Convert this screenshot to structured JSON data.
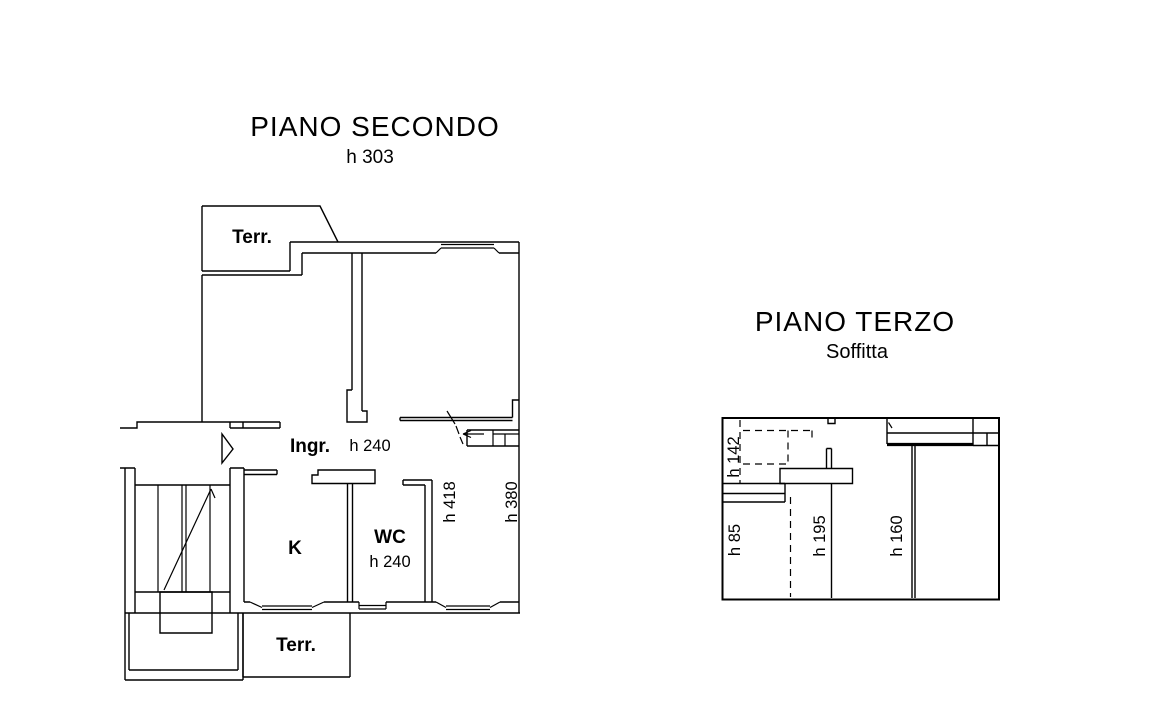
{
  "colors": {
    "ink": "#000000",
    "paper": "#ffffff"
  },
  "plan_secondo": {
    "title": "PIANO SECONDO",
    "height_note": "h 303",
    "labels": {
      "terrace_top": "Terr.",
      "entrance": "Ingr.",
      "entrance_height": "h 240",
      "kitchen": "K",
      "wc": "WC",
      "wc_height": "h 240",
      "height_right_inner": "h 418",
      "height_right_outer": "h 380",
      "terrace_bottom": "Terr."
    }
  },
  "plan_terzo": {
    "title": "PIANO TERZO",
    "subtitle": "Soffitta",
    "labels": {
      "h142": "h 142",
      "h85": "h 85",
      "h195": "h 195",
      "h160": "h 160"
    }
  }
}
